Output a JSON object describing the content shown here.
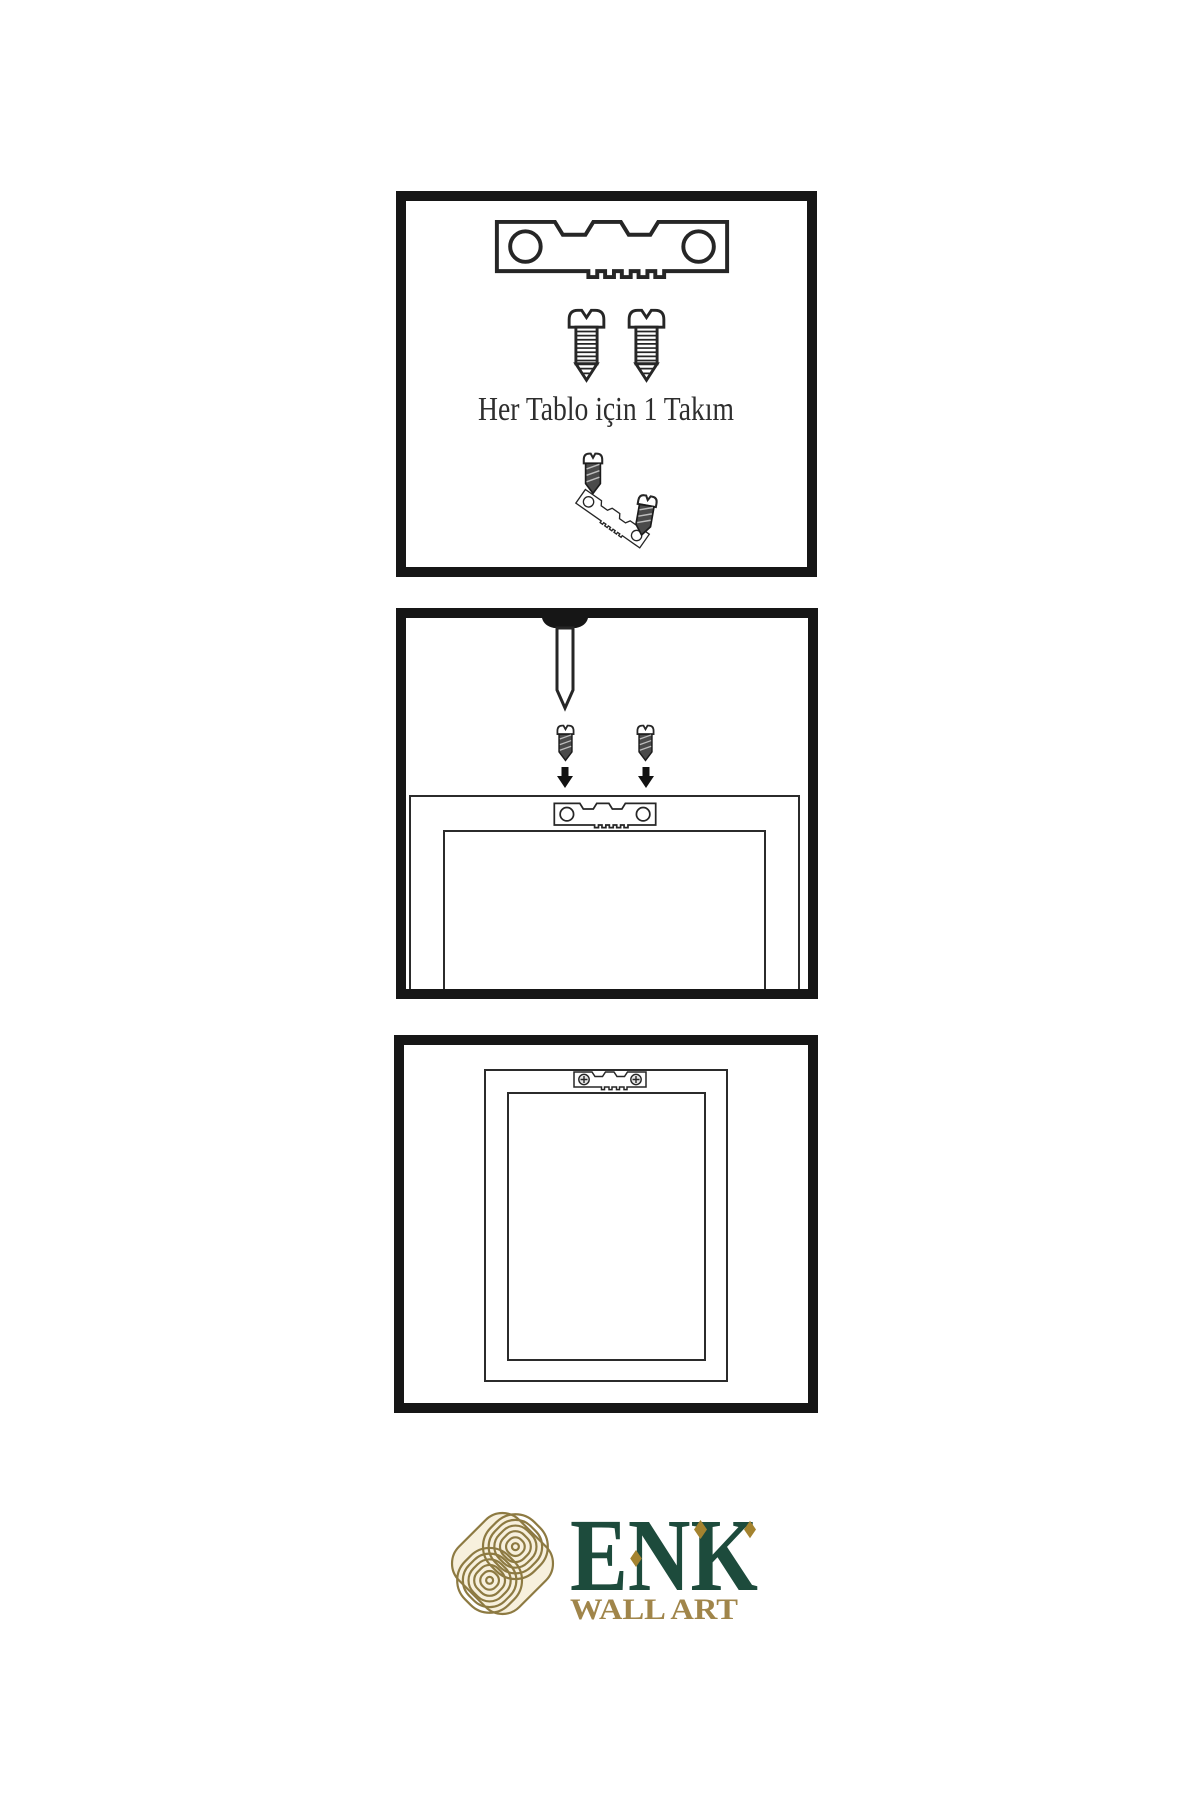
{
  "panel_1": {
    "caption": "Her Tablo için 1 Takım"
  },
  "brand": {
    "name": "ENK",
    "tagline": "WALL ART"
  },
  "colors": {
    "ink": "#161616",
    "line": "#2b2b2b",
    "brand_green": "#1d4b3c",
    "brand_gold": "#a0854a",
    "knot_gold": "#8d7a42",
    "knot_cream": "#f7f0dd",
    "diamond_gold": "#a4832f"
  },
  "icons": {
    "sawtooth_hanger": "sawtooth-hanger-icon",
    "screw": "screw-icon",
    "small_screw": "small-screw-icon",
    "nail": "nail-icon",
    "down_arrow": "down-arrow-icon",
    "mounted_hanger": "mounted-hanger-icon",
    "brand_knot": "knot-icon"
  }
}
